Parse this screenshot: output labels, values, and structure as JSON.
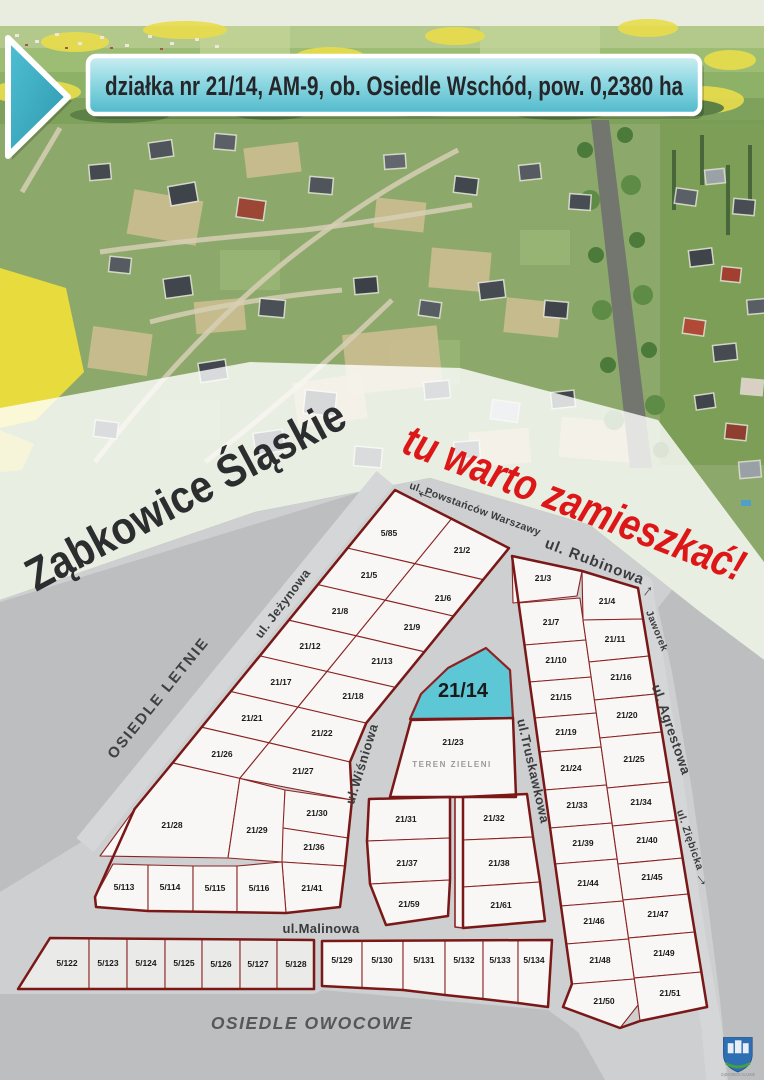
{
  "banner": {
    "text": "działka nr 21/14, AM-9, ob. Osiedle Wschód, pow. 0,2380 ha"
  },
  "overlay": {
    "city": "Ząbkowice Śląskie",
    "slogan": "tu warto zamieszkać!"
  },
  "map": {
    "highlight_plot": "21/14",
    "colors": {
      "plot_fill": "#f8f7f5",
      "plot_shade_fill": "#eaeae8",
      "plot_stroke": "#8c2323",
      "outline": "#7a1717",
      "street_gray": "#cdcfd0",
      "dark_gray": "#bcbebf",
      "highlight": "#5ec7d6",
      "label": "#1a1a1a"
    },
    "plots": [
      {
        "n": "5/85",
        "pts": "395,490 451.5,518.8 414.9,563.7 347.6,548.1",
        "l": [
          389,
          536
        ]
      },
      {
        "n": "21/2",
        "pts": "451.5,518.8 509,548.1 483.2,579.7 414.9,563.7",
        "l": [
          462,
          553
        ]
      },
      {
        "n": "21/5",
        "pts": "347.6,548.1 414.9,563.7 385.2,600.2 317.9,584.6",
        "l": [
          369,
          578
        ]
      },
      {
        "n": "21/6",
        "pts": "414.9,563.7 483.2,579.7 453.5,616.1 385.2,600.2",
        "l": [
          443,
          601
        ]
      },
      {
        "n": "21/8",
        "pts": "317.9,584.6 385.2,600.2 356.1,635.8 288.8,620.2",
        "l": [
          340,
          614
        ]
      },
      {
        "n": "21/9",
        "pts": "385.2,600.2 453.5,616.1 424.4,651.8 356.1,635.8",
        "l": [
          412,
          630
        ]
      },
      {
        "n": "21/12",
        "pts": "288.8,620.2 356.1,635.8 327,671.5 259.8,655.9",
        "l": [
          310,
          649
        ]
      },
      {
        "n": "21/13",
        "pts": "356.1,635.8 424.4,651.8 395.3,687.4 327,671.5",
        "l": [
          382,
          664
        ]
      },
      {
        "n": "21/17",
        "pts": "259.8,655.9 327,671.5 297.9,707.1 230.7,691.5",
        "l": [
          281,
          685
        ]
      },
      {
        "n": "21/18",
        "pts": "327,671.5 395.3,687.4 366.2,723.1 297.9,707.1",
        "l": [
          353,
          699
        ]
      },
      {
        "n": "21/21",
        "pts": "230.7,691.5 297.9,707.1 268.9,742.8 201.6,727.2",
        "l": [
          252,
          721
        ]
      },
      {
        "n": "21/22",
        "pts": "297.9,707.1 366.2,723.1 350,762 268.9,742.8",
        "l": [
          322,
          736
        ]
      },
      {
        "n": "21/26",
        "pts": "201.6,727.2 268.9,742.8 239.8,778.4 172.5,762.8",
        "l": [
          222,
          757
        ]
      },
      {
        "n": "21/27",
        "pts": "268.9,742.8 350,762 352,800 239.8,778.4",
        "l": [
          303,
          774
        ]
      },
      {
        "n": "21/28",
        "pts": "172.5,763 239.8,778.4 228,858 100,856 134.6,809",
        "l": [
          172,
          828
        ]
      },
      {
        "n": "21/29",
        "pts": "239.8,778.4 285,790 282,862 228,858",
        "l": [
          257,
          833
        ]
      },
      {
        "n": "21/30",
        "pts": "285,790 352,800 348,838 283,828",
        "l": [
          317,
          816
        ]
      },
      {
        "n": "21/36",
        "pts": "283,828 348,838 345,866 282,862",
        "l": [
          314,
          850
        ]
      },
      {
        "n": "21/41",
        "pts": "282,862 345,866 340,907 286,913",
        "l": [
          312,
          891
        ]
      },
      {
        "n": "5/113",
        "pts": "95,897 113,864 148,865 148,911 96,907",
        "l": [
          124,
          890
        ]
      },
      {
        "n": "5/114",
        "pts": "148,865 193,866 193,911 148,911",
        "l": [
          170,
          890
        ]
      },
      {
        "n": "5/115",
        "pts": "193,866 237,866 237,912 193,911",
        "l": [
          215,
          891
        ]
      },
      {
        "n": "5/116",
        "pts": "237,866 282,862 286,913 237,912",
        "l": [
          259,
          891
        ]
      },
      {
        "n": "21/14",
        "pts": "486,648 510,670 513,718 410,719 421,694 448,668",
        "l": [
          463,
          697
        ],
        "cls": "highlight",
        "fs": 20
      },
      {
        "n": "21/23",
        "pts": "411,720 513,718 516,797 390,797",
        "l": [
          453,
          745
        ]
      },
      {
        "n": "21/31",
        "pts": "369,799 450,797 450,838 367,841",
        "l": [
          406,
          822
        ]
      },
      {
        "n": "21/37",
        "pts": "367,841 450,838 450,880 370,884",
        "l": [
          407,
          866
        ]
      },
      {
        "n": "21/59",
        "pts": "370,884 450,880 448,916 386,925",
        "l": [
          409,
          907
        ]
      },
      {
        "n": "",
        "pts": "455,797 463,797 463,928 455,927",
        "cls": "lane"
      },
      {
        "n": "21/32",
        "pts": "463,797 527,794 533,837 463,840",
        "l": [
          494,
          821
        ]
      },
      {
        "n": "21/38",
        "pts": "463,840 533,837 540,882 463,887",
        "l": [
          499,
          866
        ]
      },
      {
        "n": "21/61",
        "pts": "463,887 540,882 545,921 463,928",
        "l": [
          501,
          908
        ]
      },
      {
        "n": "21/3",
        "pts": "512,556 582,571 577,596 513,603",
        "l": [
          543,
          581
        ]
      },
      {
        "n": "21/4",
        "pts": "582,571 638,588 643.1,619 583,620",
        "l": [
          607,
          604
        ]
      },
      {
        "n": "21/7",
        "pts": "518.6,603 579.9,598 585.9,640 524.5,645",
        "l": [
          551,
          625
        ]
      },
      {
        "n": "21/10",
        "pts": "524.5,645 585.9,640 591.2,677 529.6,682",
        "l": [
          556,
          663
        ]
      },
      {
        "n": "21/15",
        "pts": "529.6,682 591.2,677 596.3,713 534.7,718",
        "l": [
          561,
          700
        ]
      },
      {
        "n": "21/19",
        "pts": "534.7,718 596.3,713 601.2,747 539.4,752",
        "l": [
          566,
          735
        ]
      },
      {
        "n": "21/24",
        "pts": "539.4,752 601.2,747 606.6,785 544.8,790",
        "l": [
          571,
          771
        ]
      },
      {
        "n": "21/33",
        "pts": "544.8,790 606.6,785 612,823 550.1,828",
        "l": [
          577,
          808
        ]
      },
      {
        "n": "21/39",
        "pts": "550.1,828 612,823 617.2,859 555.1,864",
        "l": [
          583,
          846
        ]
      },
      {
        "n": "21/44",
        "pts": "555.1,864 617.2,859 623.2,901 561,906",
        "l": [
          588,
          886
        ]
      },
      {
        "n": "21/46",
        "pts": "561,906 623.2,901 628.6,939 566.3,944",
        "l": [
          594,
          924
        ]
      },
      {
        "n": "21/48",
        "pts": "566.3,944 628.6,939 634.3,979 571.9,984",
        "l": [
          600,
          963
        ]
      },
      {
        "n": "21/50",
        "pts": "571.9,984 634.3,979 638.1,1005 620,1028 563,1007",
        "l": [
          604,
          1004
        ]
      },
      {
        "n": "21/11",
        "pts": "583,620 643.1,619 649.2,656 589,662",
        "l": [
          615,
          642
        ]
      },
      {
        "n": "21/16",
        "pts": "589,662 649.2,656 655.5,694 594.4,700",
        "l": [
          621,
          680
        ]
      },
      {
        "n": "21/20",
        "pts": "594.4,700 655.5,694 661.8,732 599.9,738",
        "l": [
          627,
          718
        ]
      },
      {
        "n": "21/25",
        "pts": "599.9,738 661.8,732 670,782 607,788",
        "l": [
          634,
          762
        ]
      },
      {
        "n": "21/34",
        "pts": "607,788 670,782 676.3,820 612.5,826",
        "l": [
          641,
          805
        ]
      },
      {
        "n": "21/40",
        "pts": "612.5,826 676.3,820 682.6,858 617.9,864",
        "l": [
          647,
          843
        ]
      },
      {
        "n": "21/45",
        "pts": "617.9,864 682.6,858 688.5,894 623,900",
        "l": [
          652,
          880
        ]
      },
      {
        "n": "21/47",
        "pts": "623,900 688.5,894 694.8,932 628.5,938",
        "l": [
          658,
          917
        ]
      },
      {
        "n": "21/49",
        "pts": "628.5,938 694.8,932 701.4,972 634.2,978",
        "l": [
          664,
          956
        ]
      },
      {
        "n": "21/51",
        "pts": "634.2,978 701.4,972 707.1,1007 640,1021 638.1,1005",
        "l": [
          670,
          996
        ]
      },
      {
        "n": "5/122",
        "pts": "50,938 89,938 89,989 18,989",
        "cls": "shade",
        "l": [
          67,
          966
        ]
      },
      {
        "n": "5/123",
        "pts": "89,938 127,938 127,989 89,989",
        "cls": "shade",
        "l": [
          108,
          966
        ]
      },
      {
        "n": "5/124",
        "pts": "127,938 165,939 165,989 127,989",
        "cls": "shade",
        "l": [
          146,
          966
        ]
      },
      {
        "n": "5/125",
        "pts": "165,939 202,939 202,989 165,989",
        "cls": "shade",
        "l": [
          184,
          966
        ]
      },
      {
        "n": "5/126",
        "pts": "202,939 240,940 240,989 202,989",
        "cls": "shade",
        "l": [
          221,
          967
        ]
      },
      {
        "n": "5/127",
        "pts": "240,940 277,940 277,989 240,989",
        "cls": "shade",
        "l": [
          258,
          967
        ]
      },
      {
        "n": "5/128",
        "pts": "277,940 314,940 314,989 277,989",
        "cls": "shade",
        "l": [
          296,
          967
        ]
      },
      {
        "n": "5/129",
        "pts": "322,941 362,941 362,988 322,986",
        "l": [
          342,
          963
        ]
      },
      {
        "n": "5/130",
        "pts": "362,941 403,941 403,990 362,988",
        "l": [
          382,
          963
        ]
      },
      {
        "n": "5/131",
        "pts": "403,941 445,941 445,995 403,990",
        "l": [
          424,
          963
        ]
      },
      {
        "n": "5/132",
        "pts": "445,941 483,941 483,999 445,995",
        "l": [
          464,
          963
        ]
      },
      {
        "n": "5/133",
        "pts": "483,941 518,940 518,1003 483,999",
        "l": [
          500,
          963
        ]
      },
      {
        "n": "5/134",
        "pts": "518,940 552,940 548,1007 518,1003",
        "l": [
          534,
          963
        ]
      }
    ],
    "outlines": [
      "395,490 451.5,518.8 509,548.1 483.2,579.7 453.5,616.1 424.4,651.8 395.3,687.4 366.2,723.1 350,762 352,800 348,838 345,866 340,907 286,913 148,911 96,907 95,897 134.6,809 172.5,763 230.7,691.5 259.8,655.9 288.8,620.2 317.9,584.6 347.6,548.1",
      "411,720 513,718 516,797 390,797",
      "369,799 450,797 450,880 448,916 386,925 370,884 367,841",
      "463,797 527,794 533,837 540,882 545,921 463,928",
      "512,556 582,571 638,588 643.1,619 649.2,656 655.5,694 661.8,732 670,782 676.3,820 682.6,858 688.5,894 694.8,932 701.4,972 707.1,1007 640,1021 620,1028 563,1007 571.9,984 566.3,944 561,906 555.1,864 550.1,828 544.8,790 539.4,752 534.7,718 529.6,682 524.5,645 518.6,603",
      "50,938 314,940 314,989 18,989",
      "322,941 552,940 548,1007 518,1003 483,999 445,995 403,990 362,988 322,986"
    ],
    "streets": [
      {
        "n": "ul. Powstańców Warszawy",
        "x": 474,
        "y": 512,
        "r": 20,
        "fs": 10.5,
        "ls": 0.3
      },
      {
        "n": "ul. Rubinowa",
        "x": 593,
        "y": 566,
        "r": 21,
        "fs": 15,
        "ls": 1
      },
      {
        "n": "ul. Jeżynowa",
        "x": 286,
        "y": 606,
        "r": -53,
        "fs": 12.5,
        "ls": 0.5
      },
      {
        "n": "ul.Wiśniowa",
        "x": 366,
        "y": 765,
        "r": -73,
        "fs": 13,
        "ls": 0.8
      },
      {
        "n": "ul.Truskawkowa",
        "x": 529,
        "y": 772,
        "r": 77,
        "fs": 13,
        "ls": 0.5
      },
      {
        "n": "Jaworek",
        "x": 654,
        "y": 632,
        "r": 68,
        "fs": 10,
        "ls": 0.5
      },
      {
        "n": "ul. Agrestowa",
        "x": 667,
        "y": 731,
        "r": 71,
        "fs": 13.5,
        "ls": 0.5
      },
      {
        "n": "ul. Ziębicka",
        "x": 687,
        "y": 841,
        "r": 71,
        "fs": 10.5,
        "ls": 0.5
      },
      {
        "n": "ul.Malinowa",
        "x": 321,
        "y": 933,
        "r": 0,
        "fs": 13,
        "ls": 0.3
      }
    ],
    "arrows": [
      {
        "name": "arrow-left-powstancow",
        "g": "←",
        "x": 424,
        "y": 499,
        "r": 20,
        "fs": 22
      },
      {
        "name": "arrow-up-jaworek",
        "g": "→",
        "x": 650,
        "y": 593,
        "r": -52,
        "fs": 17
      },
      {
        "name": "arrow-down-ziebicka",
        "g": "→",
        "x": 699,
        "y": 882,
        "r": 52,
        "fs": 17
      }
    ],
    "areas": [
      {
        "n": "OSIEDLE LETNIE",
        "x": 162,
        "y": 701,
        "r": -51,
        "fs": 15,
        "ls": 2,
        "fill": "#3e4042",
        "italic": false
      },
      {
        "n": "OSIEDLE OWOCOWE",
        "x": 312,
        "y": 1029,
        "r": 0,
        "fs": 17.5,
        "ls": 1.5,
        "fill": "#54585b",
        "italic": true
      },
      {
        "n": "TEREN ZIELENI",
        "x": 452,
        "y": 767,
        "r": 0,
        "fs": 8,
        "ls": 1.5,
        "fill": "#9a9a9a",
        "italic": false
      }
    ]
  },
  "logo": {
    "caption": "ZĄBKOWICE ŚLĄSKIE"
  }
}
